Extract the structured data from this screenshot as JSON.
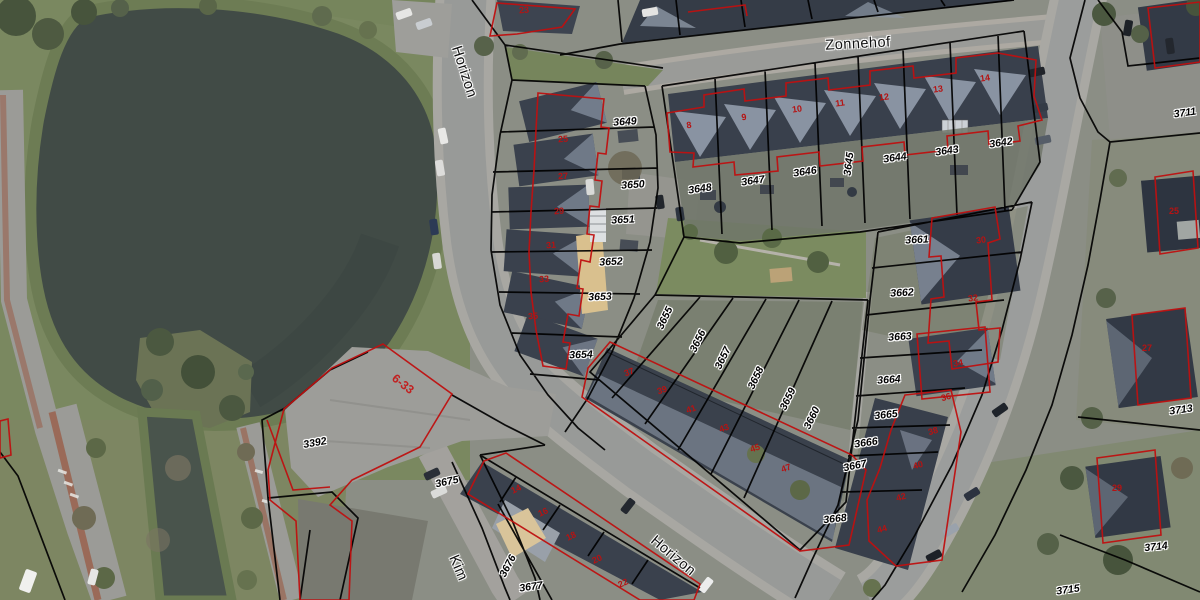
{
  "app": {
    "type": "cadastral-aerial-map"
  },
  "map": {
    "streets": [
      {
        "text": "Zonnehof",
        "x": 858,
        "y": 44,
        "rot": -3
      },
      {
        "text": "Horizon",
        "x": 464,
        "y": 72,
        "rot": 72
      },
      {
        "text": "Horizon",
        "x": 673,
        "y": 556,
        "rot": 40
      },
      {
        "text": "Kim",
        "x": 458,
        "y": 568,
        "rot": 67
      }
    ],
    "parcels": [
      {
        "text": "3649",
        "x": 625,
        "y": 122,
        "rot": -4
      },
      {
        "text": "3650",
        "x": 633,
        "y": 185,
        "rot": -4
      },
      {
        "text": "3651",
        "x": 623,
        "y": 220,
        "rot": -3
      },
      {
        "text": "3652",
        "x": 611,
        "y": 262,
        "rot": -3
      },
      {
        "text": "3653",
        "x": 600,
        "y": 297,
        "rot": -2
      },
      {
        "text": "3654",
        "x": 581,
        "y": 355,
        "rot": -2
      },
      {
        "text": "3648",
        "x": 700,
        "y": 189,
        "rot": -8
      },
      {
        "text": "3647",
        "x": 753,
        "y": 181,
        "rot": -8
      },
      {
        "text": "3646",
        "x": 805,
        "y": 172,
        "rot": -8
      },
      {
        "text": "3645",
        "x": 849,
        "y": 164,
        "rot": -83
      },
      {
        "text": "3644",
        "x": 895,
        "y": 158,
        "rot": -8
      },
      {
        "text": "3643",
        "x": 947,
        "y": 151,
        "rot": -8
      },
      {
        "text": "3642",
        "x": 1001,
        "y": 143,
        "rot": -8
      },
      {
        "text": "3655",
        "x": 665,
        "y": 318,
        "rot": -64
      },
      {
        "text": "3656",
        "x": 698,
        "y": 341,
        "rot": -64
      },
      {
        "text": "3657",
        "x": 723,
        "y": 358,
        "rot": -64
      },
      {
        "text": "3658",
        "x": 756,
        "y": 378,
        "rot": -64
      },
      {
        "text": "3659",
        "x": 788,
        "y": 399,
        "rot": -64
      },
      {
        "text": "3660",
        "x": 812,
        "y": 418,
        "rot": -64
      },
      {
        "text": "3661",
        "x": 917,
        "y": 240,
        "rot": -3
      },
      {
        "text": "3662",
        "x": 902,
        "y": 293,
        "rot": -3
      },
      {
        "text": "3663",
        "x": 900,
        "y": 337,
        "rot": -4
      },
      {
        "text": "3664",
        "x": 889,
        "y": 380,
        "rot": -4
      },
      {
        "text": "3665",
        "x": 886,
        "y": 415,
        "rot": -6
      },
      {
        "text": "3666",
        "x": 866,
        "y": 443,
        "rot": -8
      },
      {
        "text": "3667",
        "x": 855,
        "y": 466,
        "rot": -12
      },
      {
        "text": "3668",
        "x": 835,
        "y": 519,
        "rot": -6
      },
      {
        "text": "3392",
        "x": 315,
        "y": 443,
        "rot": -10
      },
      {
        "text": "3675",
        "x": 447,
        "y": 482,
        "rot": -12
      },
      {
        "text": "3676",
        "x": 508,
        "y": 566,
        "rot": -62
      },
      {
        "text": "3677",
        "x": 531,
        "y": 587,
        "rot": -8
      },
      {
        "text": "3711",
        "x": 1185,
        "y": 113,
        "rot": -8
      },
      {
        "text": "3713",
        "x": 1181,
        "y": 410,
        "rot": -8
      },
      {
        "text": "3714",
        "x": 1156,
        "y": 547,
        "rot": -6
      },
      {
        "text": "3715",
        "x": 1068,
        "y": 590,
        "rot": -8
      }
    ],
    "house_numbers": [
      {
        "text": "23",
        "x": 524,
        "y": 10,
        "rot": -5
      },
      {
        "text": "25",
        "x": 563,
        "y": 139,
        "rot": -4
      },
      {
        "text": "27",
        "x": 563,
        "y": 176,
        "rot": -4
      },
      {
        "text": "29",
        "x": 559,
        "y": 211,
        "rot": -4
      },
      {
        "text": "31",
        "x": 551,
        "y": 245,
        "rot": -4
      },
      {
        "text": "33",
        "x": 544,
        "y": 279,
        "rot": -4
      },
      {
        "text": "35",
        "x": 533,
        "y": 316,
        "rot": -4
      },
      {
        "text": "8",
        "x": 689,
        "y": 125,
        "rot": -8
      },
      {
        "text": "9",
        "x": 744,
        "y": 117,
        "rot": -8
      },
      {
        "text": "10",
        "x": 797,
        "y": 109,
        "rot": -8
      },
      {
        "text": "11",
        "x": 840,
        "y": 103,
        "rot": -8
      },
      {
        "text": "12",
        "x": 884,
        "y": 97,
        "rot": -8
      },
      {
        "text": "13",
        "x": 938,
        "y": 89,
        "rot": -8
      },
      {
        "text": "14",
        "x": 985,
        "y": 78,
        "rot": -8
      },
      {
        "text": "37",
        "x": 629,
        "y": 372,
        "rot": -20
      },
      {
        "text": "39",
        "x": 662,
        "y": 390,
        "rot": -20
      },
      {
        "text": "41",
        "x": 691,
        "y": 409,
        "rot": -20
      },
      {
        "text": "43",
        "x": 724,
        "y": 428,
        "rot": -20
      },
      {
        "text": "45",
        "x": 755,
        "y": 448,
        "rot": -20
      },
      {
        "text": "47",
        "x": 786,
        "y": 468,
        "rot": -20
      },
      {
        "text": "30",
        "x": 981,
        "y": 240,
        "rot": -8
      },
      {
        "text": "32",
        "x": 973,
        "y": 298,
        "rot": -8
      },
      {
        "text": "34",
        "x": 958,
        "y": 363,
        "rot": -8
      },
      {
        "text": "36",
        "x": 946,
        "y": 397,
        "rot": -15
      },
      {
        "text": "38",
        "x": 933,
        "y": 431,
        "rot": -15
      },
      {
        "text": "40",
        "x": 918,
        "y": 465,
        "rot": -15
      },
      {
        "text": "42",
        "x": 901,
        "y": 497,
        "rot": -15
      },
      {
        "text": "44",
        "x": 882,
        "y": 529,
        "rot": -15
      },
      {
        "text": "14",
        "x": 516,
        "y": 489,
        "rot": -25
      },
      {
        "text": "16",
        "x": 543,
        "y": 512,
        "rot": -25
      },
      {
        "text": "18",
        "x": 571,
        "y": 536,
        "rot": -25
      },
      {
        "text": "20",
        "x": 597,
        "y": 559,
        "rot": -25
      },
      {
        "text": "22",
        "x": 623,
        "y": 583,
        "rot": -25
      },
      {
        "text": "25",
        "x": 1174,
        "y": 211,
        "rot": 0
      },
      {
        "text": "27",
        "x": 1147,
        "y": 348,
        "rot": 0
      },
      {
        "text": "29",
        "x": 1117,
        "y": 488,
        "rot": 0
      }
    ],
    "area_ranges": [
      {
        "text": "6-33",
        "x": 403,
        "y": 384,
        "rot": 38
      }
    ],
    "colors": {
      "water": "#414b46",
      "canal_water": "#49544c",
      "grass": "#77865e",
      "road": "#989a98",
      "sidewalk": "#a8a7a2",
      "bike_lane": "#9a6a58",
      "roof_dark": "#39404c",
      "roof_light": "#8e98a7",
      "sand": "#d9c08e",
      "parcel_line": "#000000",
      "building_line": "#bf1010",
      "label_halo": "#ffffff"
    }
  }
}
